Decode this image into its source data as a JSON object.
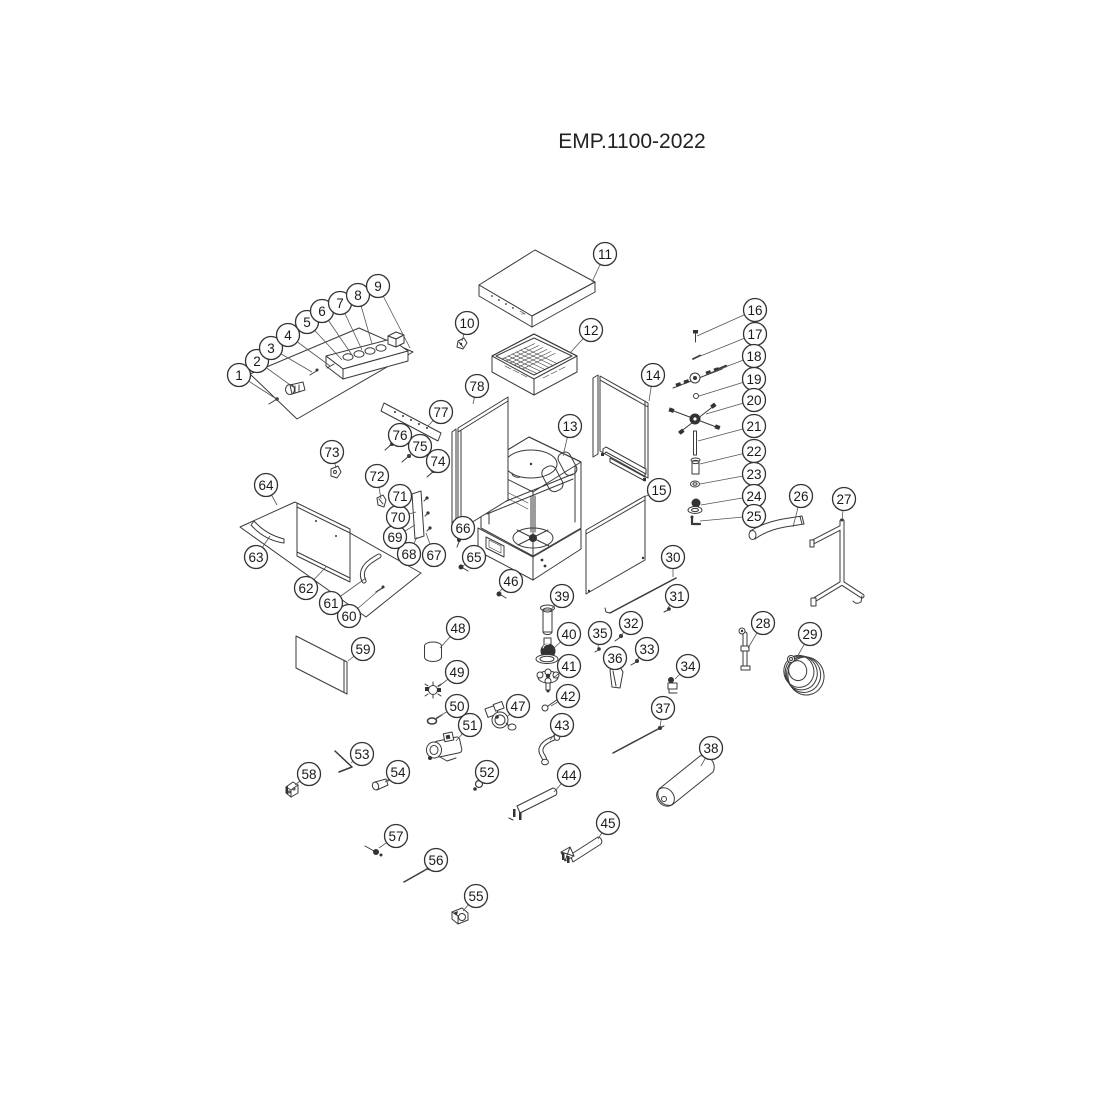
{
  "title": "EMP.1100-2022",
  "drawing": {
    "ink": "#333333",
    "background": "#ffffff",
    "leader_color": "#555555"
  },
  "callout_style": {
    "radius": 11.5,
    "font_size": 13.5
  },
  "callouts": [
    {
      "n": 1,
      "cx": 239,
      "cy": 375,
      "tx": 278,
      "ty": 400
    },
    {
      "n": 2,
      "cx": 257,
      "cy": 361,
      "tx": 293,
      "ty": 387
    },
    {
      "n": 3,
      "cx": 271,
      "cy": 348,
      "tx": 312,
      "ty": 372
    },
    {
      "n": 4,
      "cx": 288,
      "cy": 335,
      "tx": 330,
      "ty": 366
    },
    {
      "n": 5,
      "cx": 307,
      "cy": 322,
      "tx": 342,
      "ty": 360
    },
    {
      "n": 6,
      "cx": 322,
      "cy": 311,
      "tx": 352,
      "ty": 355
    },
    {
      "n": 7,
      "cx": 340,
      "cy": 303,
      "tx": 362,
      "ty": 350
    },
    {
      "n": 8,
      "cx": 358,
      "cy": 295,
      "tx": 372,
      "ty": 344
    },
    {
      "n": 9,
      "cx": 378,
      "cy": 286,
      "tx": 410,
      "ty": 348
    },
    {
      "n": 10,
      "cx": 467,
      "cy": 323,
      "tx": 462,
      "ty": 341
    },
    {
      "n": 11,
      "cx": 605,
      "cy": 254,
      "tx": 592,
      "ty": 282
    },
    {
      "n": 12,
      "cx": 591,
      "cy": 330,
      "tx": 570,
      "ty": 353
    },
    {
      "n": 13,
      "cx": 570,
      "cy": 426,
      "tx": 563,
      "ty": 456
    },
    {
      "n": 14,
      "cx": 653,
      "cy": 375,
      "tx": 649,
      "ty": 401
    },
    {
      "n": 15,
      "cx": 659,
      "cy": 490,
      "tx": 644,
      "ty": 497
    },
    {
      "n": 16,
      "cx": 755,
      "cy": 310,
      "tx": 697,
      "ty": 336
    },
    {
      "n": 17,
      "cx": 755,
      "cy": 334,
      "tx": 698,
      "ty": 357
    },
    {
      "n": 18,
      "cx": 754,
      "cy": 356,
      "tx": 707,
      "ty": 374
    },
    {
      "n": 19,
      "cx": 754,
      "cy": 379,
      "tx": 699,
      "ty": 396
    },
    {
      "n": 20,
      "cx": 754,
      "cy": 400,
      "tx": 706,
      "ty": 414
    },
    {
      "n": 21,
      "cx": 754,
      "cy": 426,
      "tx": 698,
      "ty": 441
    },
    {
      "n": 22,
      "cx": 754,
      "cy": 451,
      "tx": 700,
      "ty": 464
    },
    {
      "n": 23,
      "cx": 754,
      "cy": 474,
      "tx": 700,
      "ty": 484
    },
    {
      "n": 24,
      "cx": 754,
      "cy": 496,
      "tx": 701,
      "ty": 505
    },
    {
      "n": 25,
      "cx": 754,
      "cy": 516,
      "tx": 700,
      "ty": 521
    },
    {
      "n": 26,
      "cx": 801,
      "cy": 496,
      "tx": 793,
      "ty": 527
    },
    {
      "n": 27,
      "cx": 844,
      "cy": 499,
      "tx": 842,
      "ty": 521
    },
    {
      "n": 28,
      "cx": 763,
      "cy": 623,
      "tx": 748,
      "ty": 648
    },
    {
      "n": 29,
      "cx": 810,
      "cy": 634,
      "tx": 796,
      "ty": 659
    },
    {
      "n": 30,
      "cx": 673,
      "cy": 557,
      "tx": 673,
      "ty": 577
    },
    {
      "n": 31,
      "cx": 677,
      "cy": 596,
      "tx": 667,
      "ty": 609
    },
    {
      "n": 32,
      "cx": 631,
      "cy": 623,
      "tx": 620,
      "ty": 637
    },
    {
      "n": 33,
      "cx": 647,
      "cy": 649,
      "tx": 636,
      "ty": 661
    },
    {
      "n": 34,
      "cx": 688,
      "cy": 666,
      "tx": 675,
      "ty": 679
    },
    {
      "n": 35,
      "cx": 600,
      "cy": 633,
      "tx": 598,
      "ty": 648
    },
    {
      "n": 36,
      "cx": 615,
      "cy": 658,
      "tx": 615,
      "ty": 670
    },
    {
      "n": 37,
      "cx": 663,
      "cy": 708,
      "tx": 660,
      "ty": 727
    },
    {
      "n": 38,
      "cx": 711,
      "cy": 748,
      "tx": 701,
      "ty": 766
    },
    {
      "n": 39,
      "cx": 562,
      "cy": 596,
      "tx": 550,
      "ty": 611
    },
    {
      "n": 40,
      "cx": 569,
      "cy": 634,
      "tx": 553,
      "ty": 649
    },
    {
      "n": 41,
      "cx": 569,
      "cy": 666,
      "tx": 553,
      "ty": 678
    },
    {
      "n": 42,
      "cx": 568,
      "cy": 696,
      "tx": 551,
      "ty": 706
    },
    {
      "n": 43,
      "cx": 562,
      "cy": 725,
      "tx": 550,
      "ty": 740
    },
    {
      "n": 44,
      "cx": 569,
      "cy": 775,
      "tx": 554,
      "ty": 792
    },
    {
      "n": 45,
      "cx": 608,
      "cy": 823,
      "tx": 598,
      "ty": 839
    },
    {
      "n": 46,
      "cx": 511,
      "cy": 581,
      "tx": 499,
      "ty": 592
    },
    {
      "n": 47,
      "cx": 518,
      "cy": 706,
      "tx": 507,
      "ty": 717
    },
    {
      "n": 48,
      "cx": 458,
      "cy": 628,
      "tx": 440,
      "ty": 648
    },
    {
      "n": 49,
      "cx": 457,
      "cy": 672,
      "tx": 438,
      "ty": 687
    },
    {
      "n": 50,
      "cx": 457,
      "cy": 706,
      "tx": 436,
      "ty": 718
    },
    {
      "n": 51,
      "cx": 470,
      "cy": 725,
      "tx": 456,
      "ty": 741
    },
    {
      "n": 52,
      "cx": 487,
      "cy": 772,
      "tx": 480,
      "ty": 782
    },
    {
      "n": 53,
      "cx": 362,
      "cy": 754,
      "tx": 351,
      "ty": 763
    },
    {
      "n": 54,
      "cx": 398,
      "cy": 772,
      "tx": 385,
      "ty": 782
    },
    {
      "n": 55,
      "cx": 476,
      "cy": 896,
      "tx": 463,
      "ty": 911
    },
    {
      "n": 56,
      "cx": 436,
      "cy": 860,
      "tx": 424,
      "ty": 871
    },
    {
      "n": 57,
      "cx": 396,
      "cy": 836,
      "tx": 379,
      "ty": 848
    },
    {
      "n": 58,
      "cx": 309,
      "cy": 774,
      "tx": 295,
      "ty": 785
    },
    {
      "n": 59,
      "cx": 363,
      "cy": 649,
      "tx": 348,
      "ty": 661
    },
    {
      "n": 60,
      "cx": 349,
      "cy": 616,
      "tx": 378,
      "ty": 591
    },
    {
      "n": 61,
      "cx": 331,
      "cy": 603,
      "tx": 366,
      "ty": 578
    },
    {
      "n": 62,
      "cx": 306,
      "cy": 588,
      "tx": 326,
      "ty": 567
    },
    {
      "n": 63,
      "cx": 256,
      "cy": 557,
      "tx": 270,
      "ty": 536
    },
    {
      "n": 64,
      "cx": 266,
      "cy": 485,
      "tx": 277,
      "ty": 505
    },
    {
      "n": 65,
      "cx": 474,
      "cy": 557,
      "tx": 463,
      "ty": 566
    },
    {
      "n": 66,
      "cx": 463,
      "cy": 528,
      "tx": 460,
      "ty": 540
    },
    {
      "n": 67,
      "cx": 434,
      "cy": 555,
      "tx": 426,
      "ty": 533
    },
    {
      "n": 68,
      "cx": 409,
      "cy": 554,
      "tx": 417,
      "ty": 537
    },
    {
      "n": 69,
      "cx": 395,
      "cy": 537,
      "tx": 415,
      "ty": 525
    },
    {
      "n": 70,
      "cx": 398,
      "cy": 517,
      "tx": 416,
      "ty": 512
    },
    {
      "n": 71,
      "cx": 400,
      "cy": 496,
      "tx": 413,
      "ty": 497
    },
    {
      "n": 72,
      "cx": 377,
      "cy": 476,
      "tx": 381,
      "ty": 499
    },
    {
      "n": 73,
      "cx": 332,
      "cy": 452,
      "tx": 336,
      "ty": 468
    },
    {
      "n": 74,
      "cx": 438,
      "cy": 461,
      "tx": 431,
      "ty": 472
    },
    {
      "n": 75,
      "cx": 420,
      "cy": 446,
      "tx": 407,
      "ty": 457
    },
    {
      "n": 76,
      "cx": 400,
      "cy": 435,
      "tx": 389,
      "ty": 446
    },
    {
      "n": 77,
      "cx": 441,
      "cy": 412,
      "tx": 428,
      "ty": 426
    },
    {
      "n": 78,
      "cx": 477,
      "cy": 386,
      "tx": 473,
      "ty": 404
    }
  ]
}
